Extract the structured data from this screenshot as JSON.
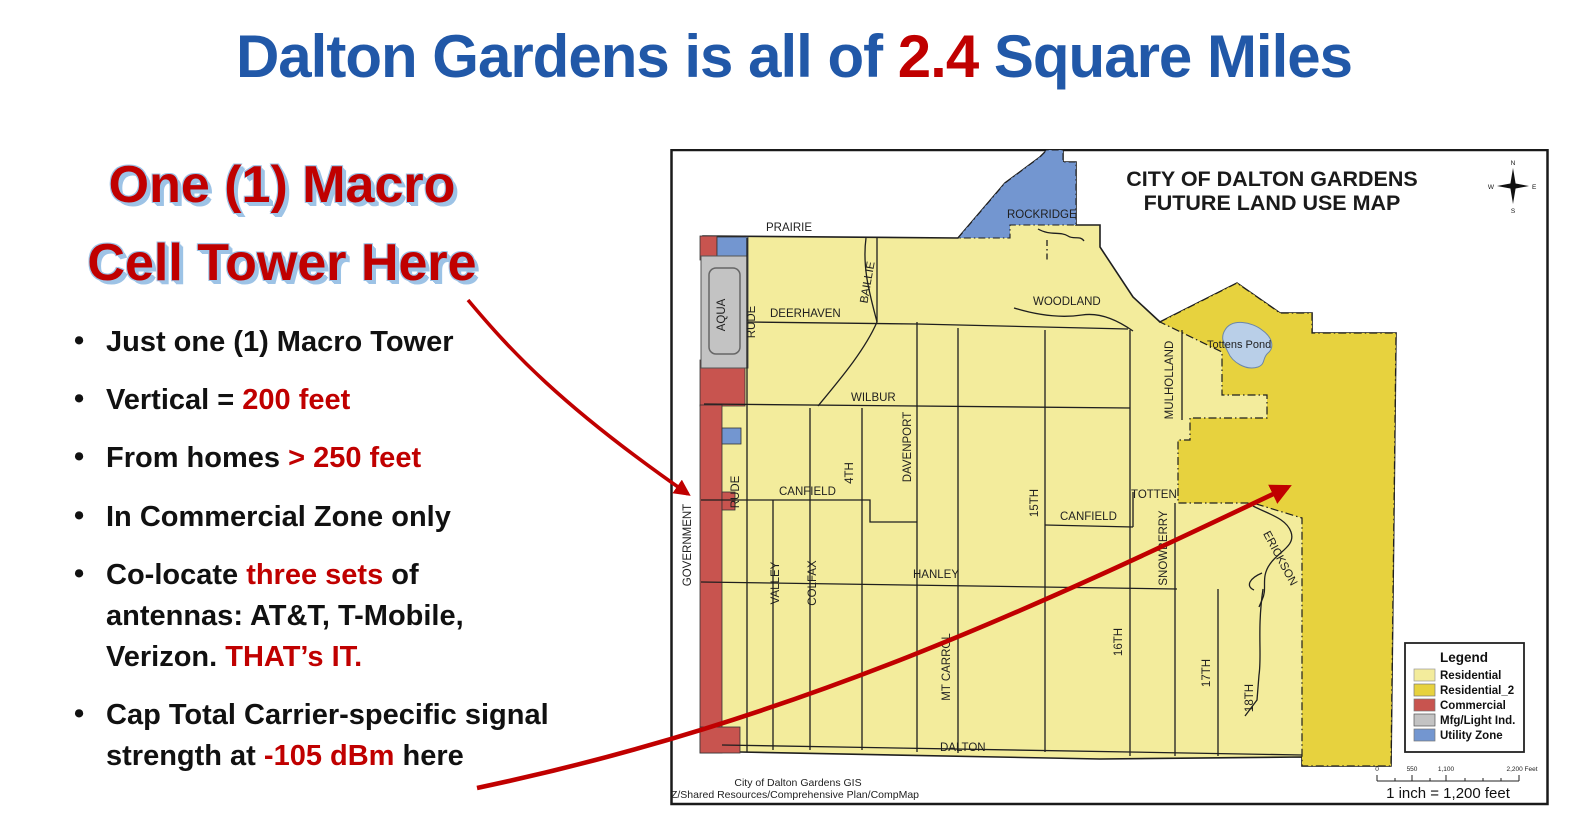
{
  "title": {
    "prefix": "Dalton Gardens is all of ",
    "highlight": "2.4",
    "suffix": " Square Miles"
  },
  "callout": {
    "line1": "One (1) Macro",
    "line2": "Cell Tower Here"
  },
  "bullets": [
    {
      "segments": [
        {
          "text": "Just one (1) Macro Tower",
          "style": "default"
        }
      ]
    },
    {
      "segments": [
        {
          "text": "Vertical = ",
          "style": "default"
        },
        {
          "text": "200 feet",
          "style": "red"
        }
      ]
    },
    {
      "segments": [
        {
          "text": "From homes ",
          "style": "default"
        },
        {
          "text": "> 250 feet",
          "style": "red"
        }
      ]
    },
    {
      "segments": [
        {
          "text": "In Commercial Zone only",
          "style": "default"
        }
      ]
    },
    {
      "segments": [
        {
          "text": "Co-locate ",
          "style": "default"
        },
        {
          "text": "three sets",
          "style": "red"
        },
        {
          "text": " of\nantennas: AT&T, T-Mobile,\nVerizon. ",
          "style": "default"
        },
        {
          "text": "THAT’s IT.",
          "style": "red"
        }
      ]
    },
    {
      "segments": [
        {
          "text": "Cap Total Carrier-specific signal\nstrength at ",
          "style": "default"
        },
        {
          "text": "-105 dBm",
          "style": "red"
        },
        {
          "text": " here",
          "style": "default"
        }
      ]
    }
  ],
  "map": {
    "title1": "CITY OF DALTON GARDENS",
    "title2": "FUTURE LAND USE MAP",
    "labels": {
      "prairie": "PRAIRIE",
      "rockridge": "ROCKRIDGE",
      "woodland": "WOODLAND",
      "deerhaven": "DEERHAVEN",
      "wilbur": "WILBUR",
      "canfield": "CANFIELD",
      "totten": "TOTTEN",
      "hanley": "HANLEY",
      "dalton": "DALTON",
      "aqua": "AQUA",
      "government": "GOVERNMENT",
      "rude": "RUDE",
      "valley": "VALLEY",
      "colfax": "COLFAX",
      "fourth": "4TH",
      "baillie": "BAILLIE",
      "davenport": "DAVENPORT",
      "mt_carrol": "MT CARROL",
      "fifteenth": "15TH",
      "sixteenth": "16TH",
      "snowberry": "SNOWBERRY",
      "mulholland": "MULHOLLAND",
      "seventeenth": "17TH",
      "eighteenth": "18TH",
      "erickson": "ERICKSON",
      "pond": "Tottens Pond"
    },
    "legend": {
      "title": "Legend",
      "items": [
        {
          "label": "Residential",
          "color": "#F3EC9C"
        },
        {
          "label": "Residential_2",
          "color": "#E7D23E"
        },
        {
          "label": "Commercial",
          "color": "#C8544F"
        },
        {
          "label": "Mfg/Light Ind.",
          "color": "#C3C3C3"
        },
        {
          "label": "Utility Zone",
          "color": "#7396D0"
        }
      ]
    },
    "scale": {
      "t0": "0",
      "t550": "550",
      "t1100": "1,100",
      "t2200": "2,200 Feet",
      "note": "1 inch = 1,200 feet"
    },
    "credits": {
      "line1": "City of Dalton Gardens GIS",
      "line2": "Z/Shared Resources/Comprehensive Plan/CompMap"
    },
    "compass": {
      "n": "N",
      "e": "E",
      "s": "S",
      "w": "W"
    }
  },
  "colors": {
    "title_blue": "#2158A8",
    "accent_red": "#C00000",
    "callout_halo": "#9DC3E6",
    "residential": "#F3EC9C",
    "residential2": "#E7D23E",
    "commercial": "#C8544F",
    "mfg": "#C3C3C3",
    "utility": "#7396D0",
    "pond": "#B9CFE8"
  }
}
